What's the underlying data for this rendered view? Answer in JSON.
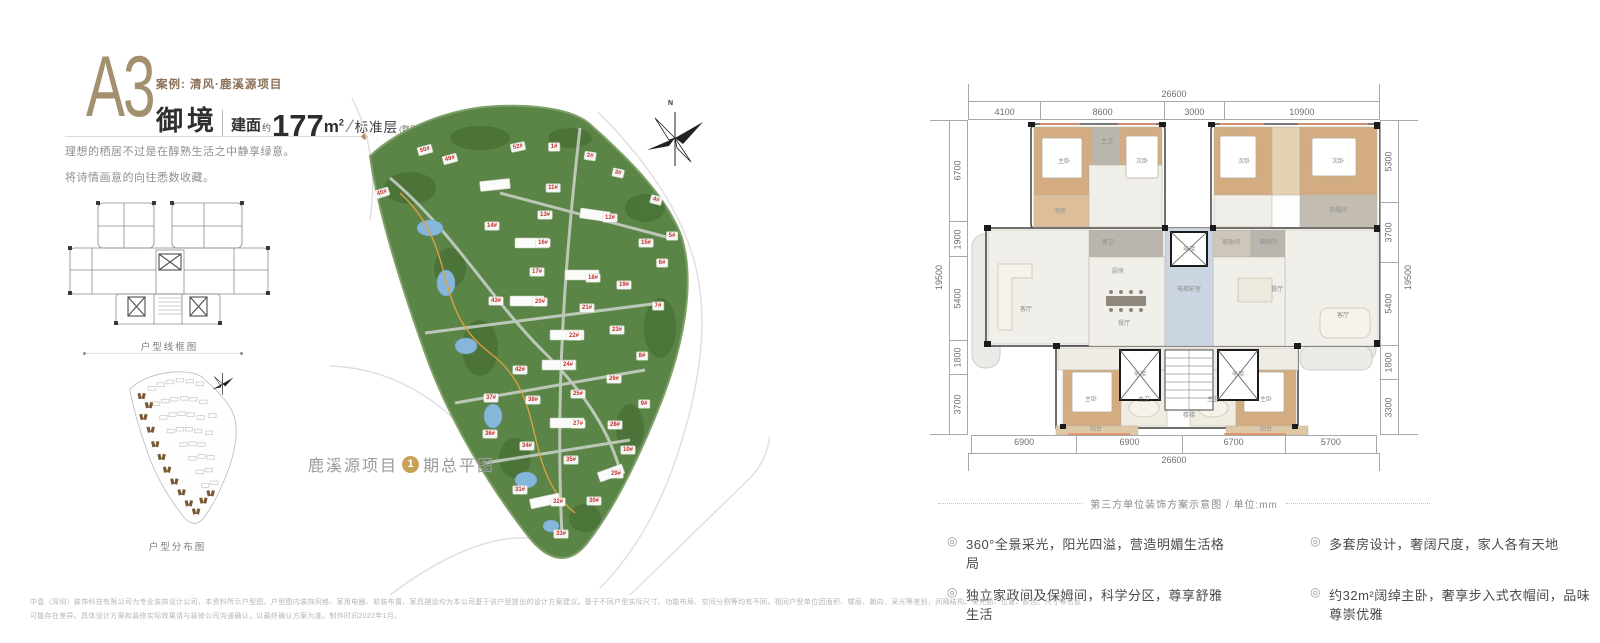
{
  "header": {
    "unit_code": "A3",
    "case_label": "案例: 清风·鹿溪源项目",
    "unit_name": "御境",
    "area_prefix": "建面",
    "area_about": "约",
    "area_value": "177",
    "area_unit": "m",
    "area_sup": "2",
    "slash": "/",
    "floor_label": "标准层",
    "floor_note": "(整层)"
  },
  "intro": {
    "line1": "理想的栖居不过是在醇熟生活之中静享绿意。",
    "line2": "将诗情画意的向往悉数收藏。"
  },
  "left_diagrams": {
    "wireframe_caption": "户型线框图",
    "distribution_caption": "户型分布图"
  },
  "site_plan": {
    "north_label": "N",
    "caption_prefix": "鹿溪源项目",
    "caption_phase": "1",
    "caption_suffix": "期总平图",
    "buildings": [
      {
        "l": "52#",
        "x": 188,
        "y": 49,
        "r": -12
      },
      {
        "l": "50#",
        "x": 95,
        "y": 52,
        "r": -15
      },
      {
        "l": "49#",
        "x": 120,
        "y": 61,
        "r": -15
      },
      {
        "l": "45#",
        "x": 52,
        "y": 95,
        "r": -18
      },
      {
        "l": "1#",
        "x": 224,
        "y": 49
      },
      {
        "l": "2#",
        "x": 260,
        "y": 58,
        "r": 8
      },
      {
        "l": "3#",
        "x": 288,
        "y": 75,
        "r": 12
      },
      {
        "l": "4#",
        "x": 326,
        "y": 102,
        "r": 15
      },
      {
        "l": "5#",
        "x": 342,
        "y": 138
      },
      {
        "l": "6#",
        "x": 332,
        "y": 165
      },
      {
        "l": "7#",
        "x": 328,
        "y": 208
      },
      {
        "l": "8#",
        "x": 312,
        "y": 258
      },
      {
        "l": "9#",
        "x": 314,
        "y": 306
      },
      {
        "l": "10#",
        "x": 298,
        "y": 352
      },
      {
        "l": "11#",
        "x": 223,
        "y": 90
      },
      {
        "l": "12#",
        "x": 280,
        "y": 120
      },
      {
        "l": "13#",
        "x": 215,
        "y": 117
      },
      {
        "l": "14#",
        "x": 162,
        "y": 128
      },
      {
        "l": "15#",
        "x": 316,
        "y": 145
      },
      {
        "l": "16#",
        "x": 213,
        "y": 145
      },
      {
        "l": "17#",
        "x": 207,
        "y": 174
      },
      {
        "l": "18#",
        "x": 263,
        "y": 180
      },
      {
        "l": "19#",
        "x": 294,
        "y": 187
      },
      {
        "l": "20#",
        "x": 210,
        "y": 204
      },
      {
        "l": "21#",
        "x": 257,
        "y": 210
      },
      {
        "l": "22#",
        "x": 244,
        "y": 238
      },
      {
        "l": "23#",
        "x": 287,
        "y": 232
      },
      {
        "l": "24#",
        "x": 238,
        "y": 267
      },
      {
        "l": "25#",
        "x": 248,
        "y": 296
      },
      {
        "l": "26#",
        "x": 284,
        "y": 281
      },
      {
        "l": "27#",
        "x": 248,
        "y": 326
      },
      {
        "l": "28#",
        "x": 285,
        "y": 327
      },
      {
        "l": "29#",
        "x": 286,
        "y": 376
      },
      {
        "l": "30#",
        "x": 264,
        "y": 403
      },
      {
        "l": "31#",
        "x": 190,
        "y": 392
      },
      {
        "l": "32#",
        "x": 228,
        "y": 404
      },
      {
        "l": "33#",
        "x": 231,
        "y": 436
      },
      {
        "l": "34#",
        "x": 197,
        "y": 348
      },
      {
        "l": "35#",
        "x": 241,
        "y": 362
      },
      {
        "l": "36#",
        "x": 160,
        "y": 336
      },
      {
        "l": "37#",
        "x": 161,
        "y": 300
      },
      {
        "l": "38#",
        "x": 203,
        "y": 302
      },
      {
        "l": "42#",
        "x": 190,
        "y": 272
      },
      {
        "l": "43#",
        "x": 166,
        "y": 203
      }
    ]
  },
  "floor_plan": {
    "dims": {
      "top_total": "26600",
      "top": [
        "4100",
        "8600",
        "3000",
        "10900"
      ],
      "left_total": "19500",
      "left": [
        "6700",
        "1900",
        "5400",
        "1800",
        "3700"
      ],
      "right": [
        "5300",
        "3700",
        "5400",
        "1800",
        "3300"
      ],
      "right_total": "19500",
      "bottom": [
        "6900",
        "6900",
        "6700",
        "5700"
      ],
      "bottom_total": "26600"
    },
    "caption": "第三方单位装饰方案示意图 / 单位:mm",
    "rooms": [
      {
        "l": "主卧",
        "x": 96,
        "y": 42
      },
      {
        "l": "主卫",
        "x": 139,
        "y": 22
      },
      {
        "l": "次卧",
        "x": 174,
        "y": 42
      },
      {
        "l": "书房",
        "x": 92,
        "y": 92
      },
      {
        "l": "客卫",
        "x": 140,
        "y": 123
      },
      {
        "l": "厨房",
        "x": 150,
        "y": 152
      },
      {
        "l": "家政间",
        "x": 263,
        "y": 123
      },
      {
        "l": "保姆间",
        "x": 300,
        "y": 123
      },
      {
        "l": "次卧",
        "x": 276,
        "y": 42
      },
      {
        "l": "次卧",
        "x": 370,
        "y": 42
      },
      {
        "l": "衣帽间",
        "x": 370,
        "y": 91
      },
      {
        "l": "客厅",
        "x": 58,
        "y": 190
      },
      {
        "l": "餐厅",
        "x": 156,
        "y": 204
      },
      {
        "l": "电梯",
        "x": 221,
        "y": 130
      },
      {
        "l": "电梯前室",
        "x": 221,
        "y": 170
      },
      {
        "l": "餐厅",
        "x": 309,
        "y": 170
      },
      {
        "l": "客厅",
        "x": 375,
        "y": 196
      },
      {
        "l": "楼梯",
        "x": 221,
        "y": 296
      },
      {
        "l": "电梯",
        "x": 172,
        "y": 255
      },
      {
        "l": "电梯",
        "x": 270,
        "y": 255
      },
      {
        "l": "主卧",
        "x": 123,
        "y": 280
      },
      {
        "l": "主卫",
        "x": 176,
        "y": 280
      },
      {
        "l": "主卫",
        "x": 245,
        "y": 280
      },
      {
        "l": "主卧",
        "x": 298,
        "y": 280
      },
      {
        "l": "阳台",
        "x": 128,
        "y": 310
      },
      {
        "l": "阳台",
        "x": 298,
        "y": 310
      }
    ]
  },
  "features": [
    {
      "text": "360°全景采光，阳光四溢，营造明媚生活格局"
    },
    {
      "text": "独立家政间及保姆间，科学分区，尊享舒雅生活"
    },
    {
      "text": "多套房设计，奢阔尺度，家人各有天地"
    },
    {
      "text": "约32m²阔绰主卧，奢享步入式衣帽间，品味尊崇优雅"
    }
  ],
  "icons": {
    "feature_marker": "◎"
  },
  "disclaimer": {
    "line1": "中壹（深圳）装饰科技有限公司为专业装饰设计公司，本资料所示户型图、户型图内装饰风格、家用电器、软装布置、家具摆设均为本公司基于该户型提出的设计方案建议。基于不同户型实际尺寸、功能布局、空间分割等均有不同，相同户型单位因面积、楼层、朝向、采光等差别，间隔结构、采光面、位置、颜色、尺寸等信息",
    "line2": "可能存在差异。具体设计方案和装修实际效果请与装修公司沟通确认，以最终确认方案为准。制作时间2022年1月。"
  },
  "colors": {
    "bronze": "#a3906f",
    "brown": "#8a7157",
    "gold": "#c9a25a",
    "building_label_red": "#c5322e",
    "site_green": "#5a8546",
    "core_blue": "#ccd5e2",
    "wood": "#d3ac81"
  }
}
